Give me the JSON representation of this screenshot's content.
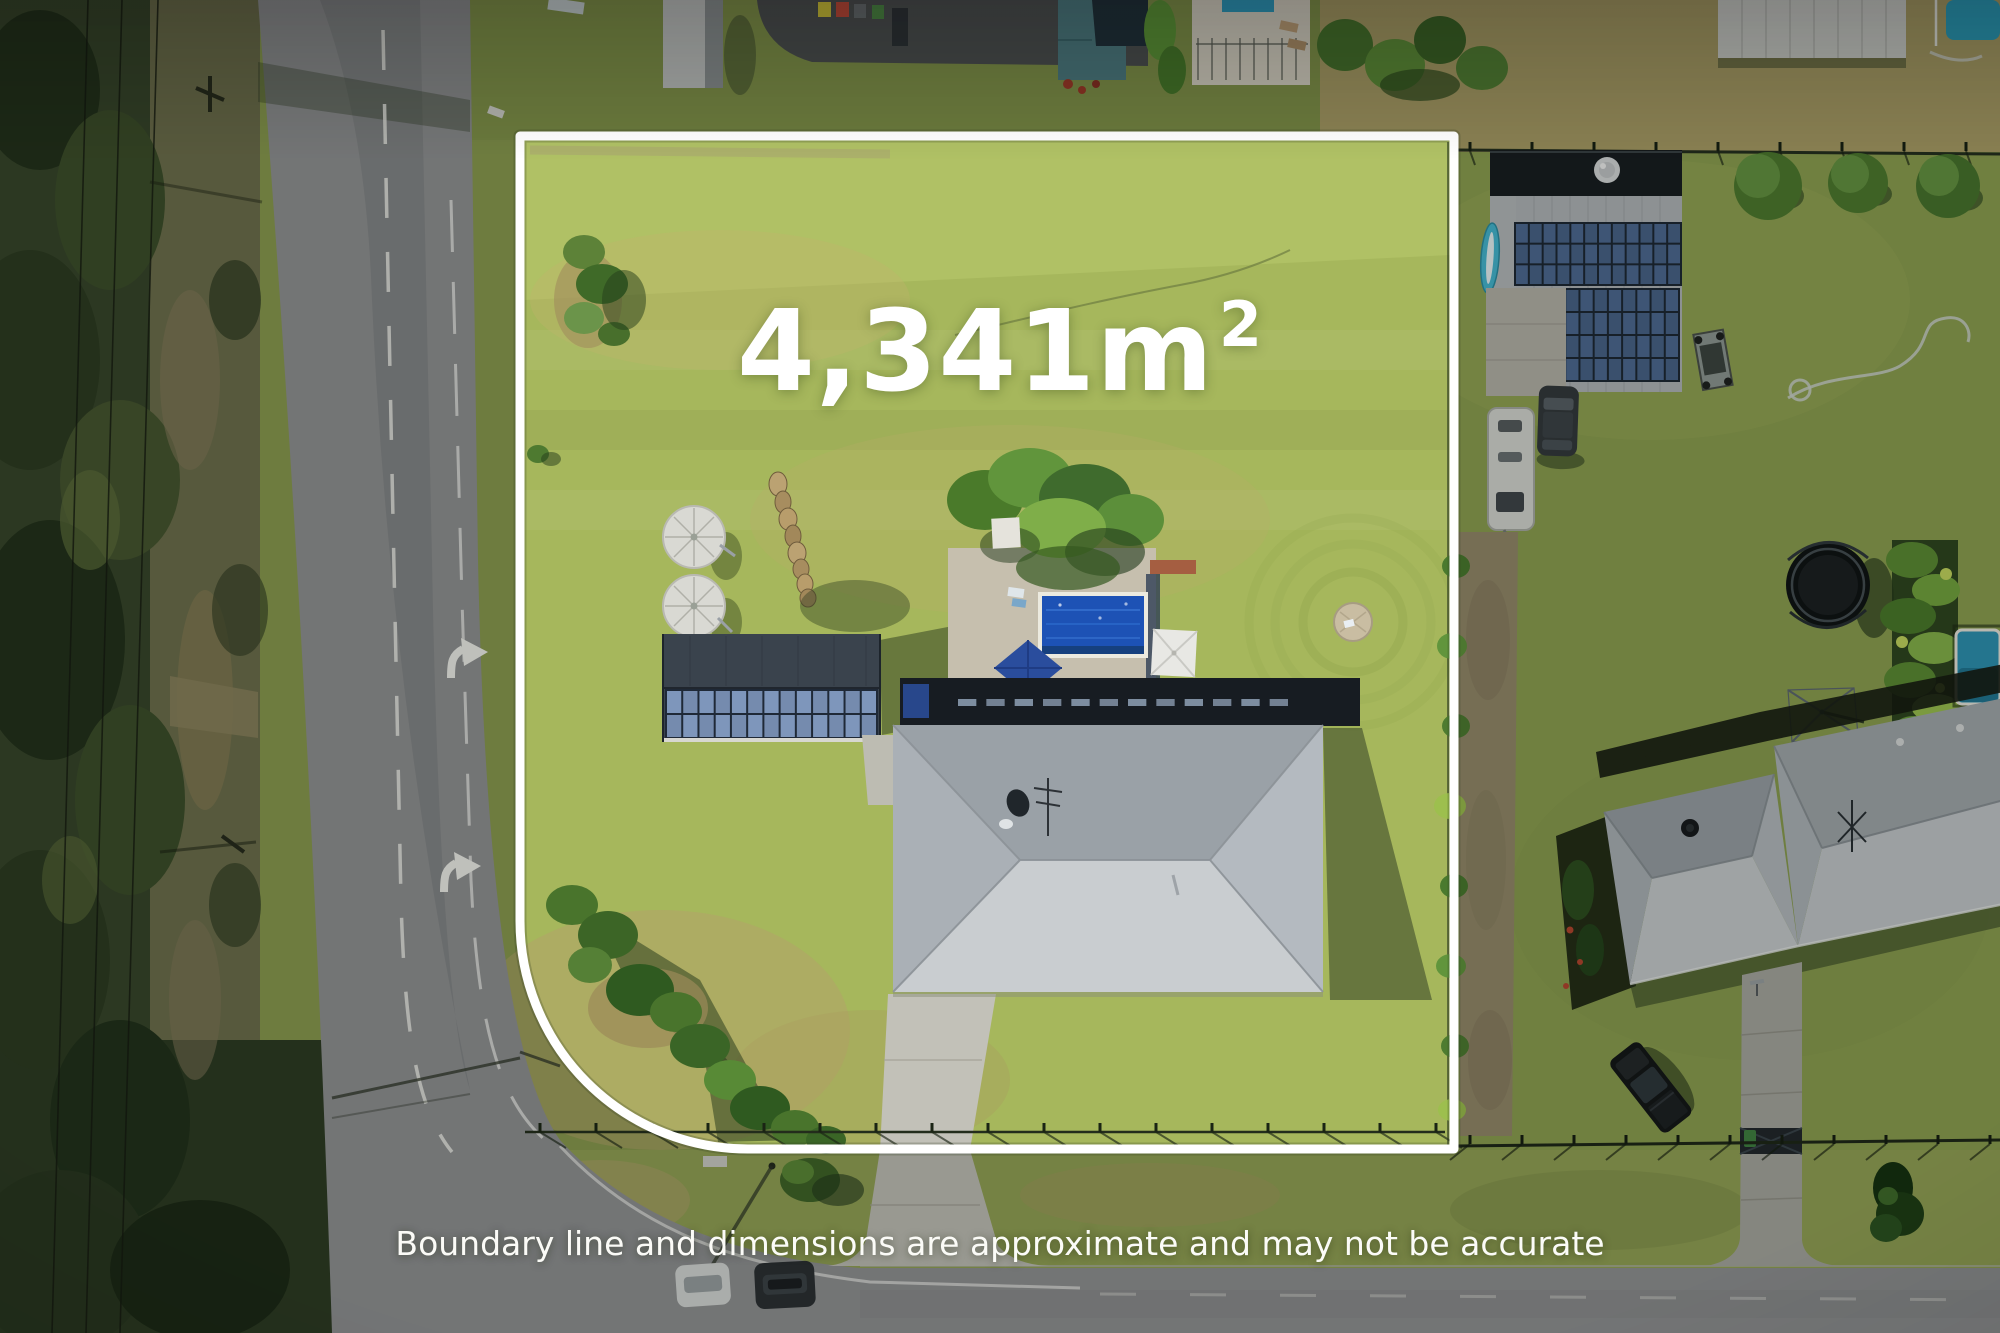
{
  "page": {
    "title": "Aerial property photograph with lot size overlay"
  },
  "overlay": {
    "area_value": "4,341m",
    "area_superscript": "2",
    "area_full": "4,341m²",
    "disclaimer": "Boundary line and dimensions are approximate and may not be accurate"
  },
  "colors": {
    "boundary_line": "#ffffff",
    "overlay_text": "#ffffff",
    "lawn_inside": "#a6b75c",
    "grass_outside": "#8b9c4f",
    "road_asphalt": "#919294",
    "pool_water": "#1d52b5",
    "neighbor_pool_water": "#2c93b4",
    "top_pool_water": "#2ba0bf",
    "solar_panel": "#4e6a94",
    "roof_light": "#c9cdd0",
    "roof_dark": "#9aa1a7",
    "shed_roof": "#3a434d",
    "forest": "#37452a"
  }
}
